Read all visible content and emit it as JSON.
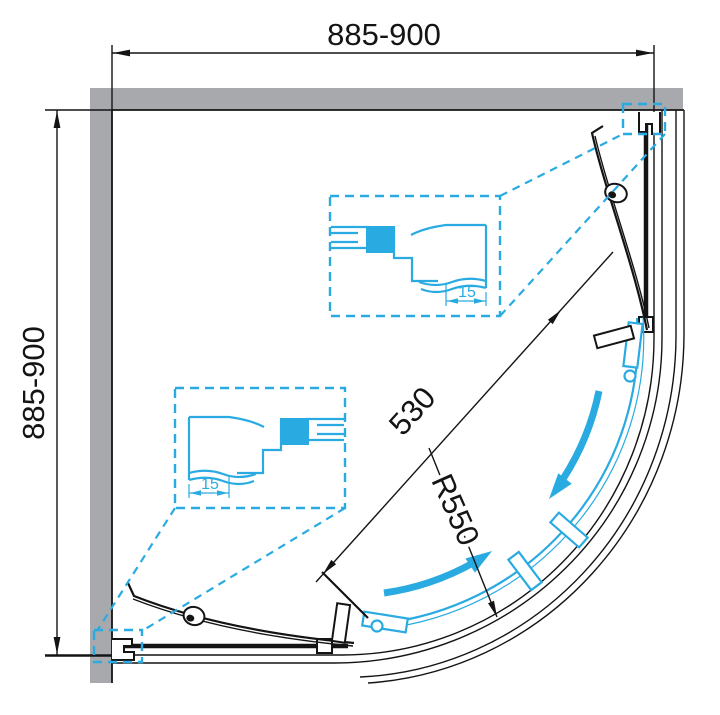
{
  "figure": {
    "type": "technical-drawing-top-view-quadrant-shower-enclosure",
    "labels": {
      "width_range": "885-900",
      "height_range": "885-900",
      "door_opening": "530",
      "radius": "R550",
      "profile_adjust_top": "15",
      "profile_adjust_left": "15"
    },
    "colors": {
      "accent": "#29abe2",
      "wall": "#a7a9ac",
      "ink": "#141414",
      "background": "#ffffff"
    }
  }
}
